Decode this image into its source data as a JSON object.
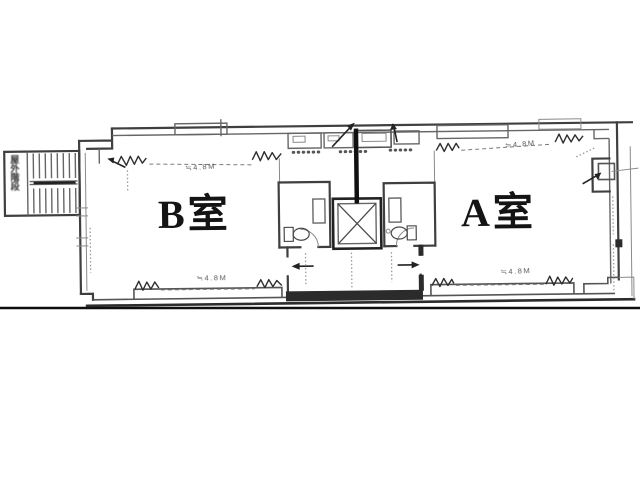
{
  "labels": {
    "room_b": "B室",
    "room_a": "A室",
    "stairs": "屋外階段"
  },
  "dims": {
    "b_top": "≒4.8M",
    "b_bottom": "≒4.8M",
    "a_top": "≒4.8M",
    "a_bottom": "≒4.8M"
  },
  "colors": {
    "paper": "#ffffff",
    "ink": "#3f3f3f",
    "ink_dark": "#121212",
    "ink_light": "#8a8a8a"
  }
}
